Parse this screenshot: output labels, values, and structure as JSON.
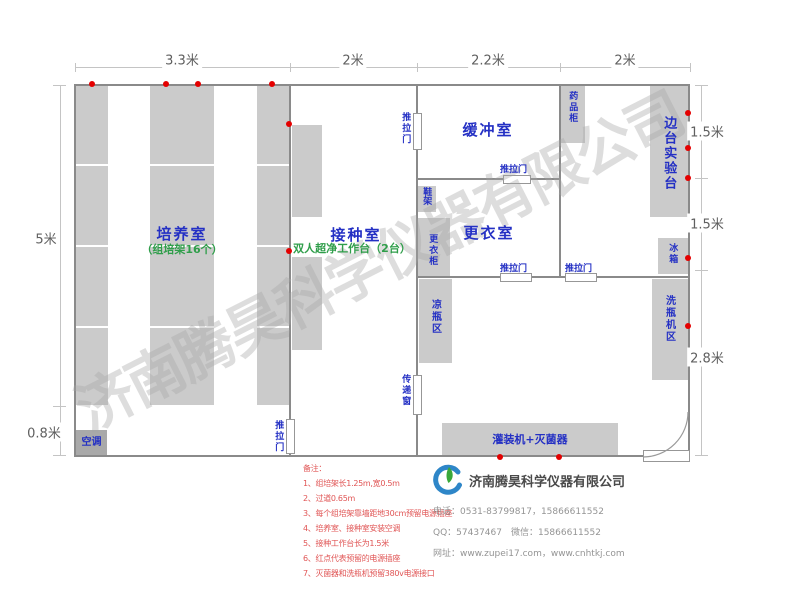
{
  "watermark": "济南腾昊科学仪器有限公司",
  "dimensions": {
    "top": [
      "3.3米",
      "2米",
      "2.2米",
      "2米"
    ],
    "left": {
      "height": "5米",
      "aisle": "0.8米"
    },
    "right": [
      "1.5米",
      "1.5米",
      "2.8米"
    ]
  },
  "rooms": {
    "cultivation": {
      "name": "培养室",
      "subtitle": "（组培架16个）"
    },
    "inoculation": {
      "name": "接种室",
      "subtitle": "双人超净工作台（2台）"
    },
    "buffer": {
      "name": "缓冲室"
    },
    "changing": {
      "name": "更衣室"
    }
  },
  "labels": {
    "sliding_door": "推拉门",
    "transfer_window": "传递窗",
    "medicine_cabinet": "药品柜",
    "side_bench": "边台实验台",
    "fridge": "冰箱",
    "shoe_rack": "鞋架",
    "wardrobe": "更衣柜",
    "bottle_cooling_area": "凉瓶区",
    "bottle_washer_area": "洗瓶机区",
    "filling_sterilizer": "灌装机+灭菌器",
    "air_conditioner": "空调"
  },
  "notes": {
    "title": "备注：",
    "items": [
      "1、组培架长1.25m,宽0.5m",
      "2、过道0.65m",
      "3、每个组培架靠墙距地30cm预留电源插座",
      "4、培养室、接种室安装空调",
      "5、接种工作台长为1.5米",
      "6、红点代表预留的电源插座",
      "7、灭菌器和洗瓶机预留380v电源接口"
    ]
  },
  "company": {
    "name": "济南腾昊科学仪器有限公司",
    "phone": "电话：0531-83799817，15866611552",
    "qq_wechat": "QQ：57437467　微信：15866611552",
    "website": "网址：www.zupei17.com，www.cnhtkj.com"
  }
}
